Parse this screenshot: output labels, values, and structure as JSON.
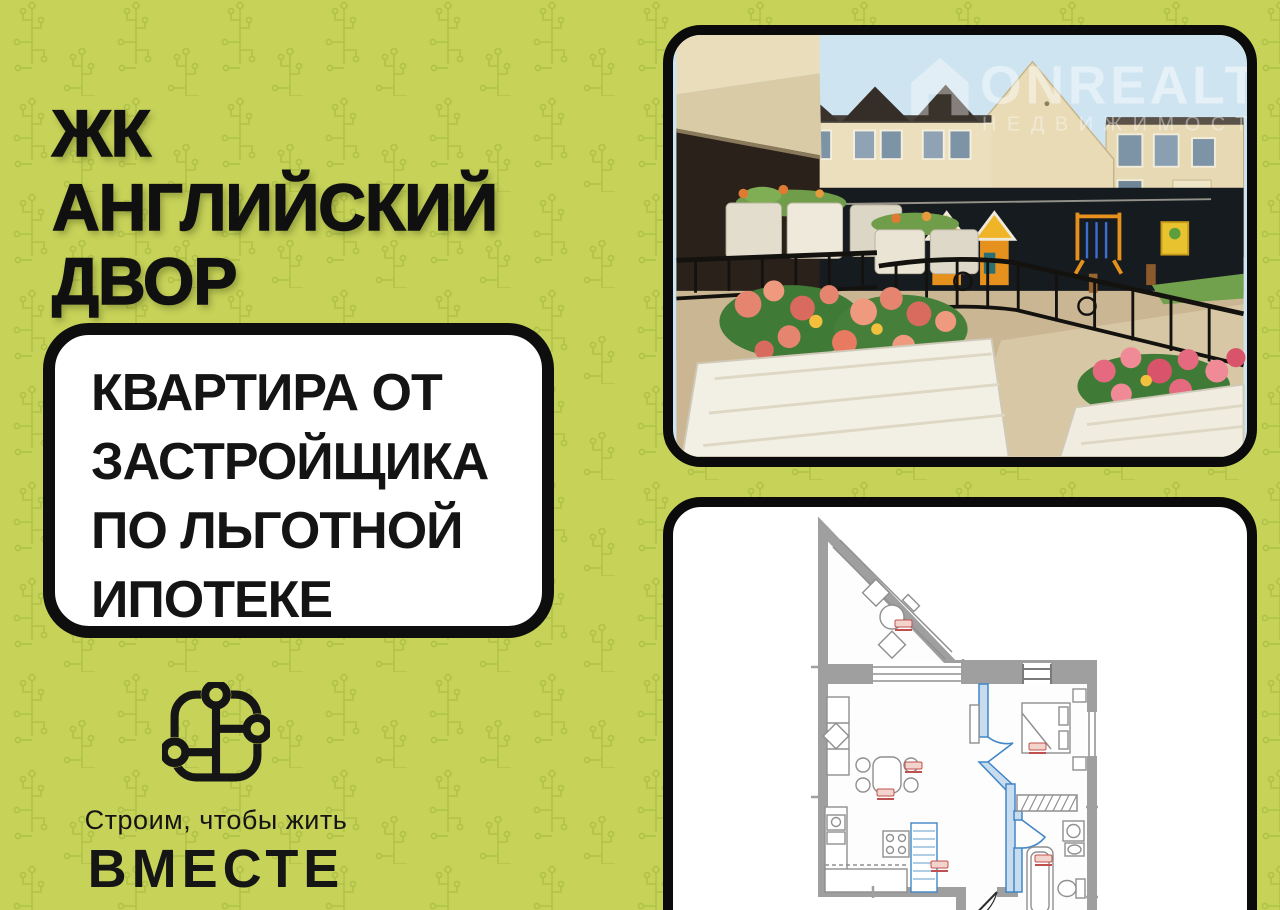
{
  "theme": {
    "background": "#c6d258",
    "pattern": "#a2b73d",
    "ink": "#101010",
    "card_bg": "#ffffff",
    "plan_wall_gray": "#a0a0a0",
    "plan_partition_blue": "#4186c6",
    "plan_label_red": "#c0504d",
    "photo_sky": "#cfe4f1",
    "photo_building_cream": "#e8dbb6",
    "photo_dark_band": "#161b20",
    "playground_orange": "#e6901d",
    "flower_coral": "#e5846f"
  },
  "header": {
    "line1": "ЖК",
    "line2": "АНГЛИЙСКИЙ ДВОР"
  },
  "offer": {
    "line1": "КВАРТИРА ОТ",
    "line2": "ЗАСТРОЙЩИКА",
    "line3": "ПО ЛЬГОТНОЙ",
    "line4": "ИПОТЕКЕ"
  },
  "brand": {
    "tagline": "Строим, чтобы жить",
    "name": "ВМЕСТЕ"
  },
  "photo": {
    "watermark_brand": "ONREALT",
    "watermark_subtitle": "НЕДВИЖИМОСТЬ"
  }
}
